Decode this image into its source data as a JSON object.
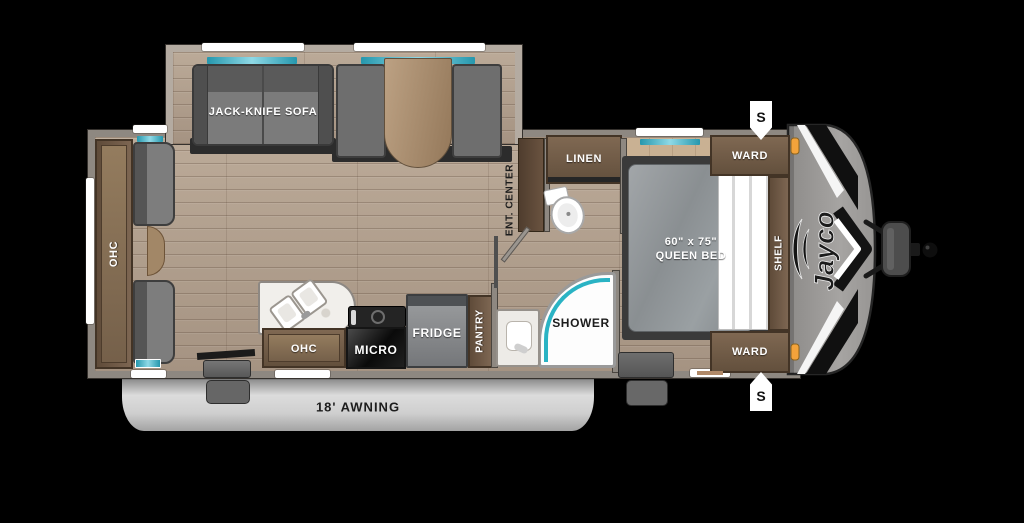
{
  "title": "Jayco travel trailer floor plan",
  "brand_logo": "Jayco",
  "awning": {
    "label": "18' AWNING"
  },
  "speakers": {
    "top": "S",
    "bottom": "S"
  },
  "labels": {
    "rear_ohc": "OHC",
    "sofa": "JACK-KNIFE SOFA",
    "ent_center": "ENT. CENTER",
    "linen": "LINEN",
    "shower": "SHOWER",
    "kitchen_ohc": "OHC",
    "micro": "MICRO",
    "fridge": "FRIDGE",
    "pantry": "PANTRY",
    "ward_top": "WARD",
    "ward_bottom": "WARD",
    "shelf": "SHELF",
    "bed_size": "60\" x 75\"",
    "bed_type": "QUEEN BED"
  },
  "colors": {
    "background": "#000000",
    "floor_wood": "#b2a192",
    "cabinet_brown": "#6f5a46",
    "wall_gray": "#8e8881",
    "accent_teal": "#2ab3c4",
    "marker_orange": "#f2a13a",
    "awning_silver": "#c9c9c9",
    "furniture_gray": "#777777"
  }
}
